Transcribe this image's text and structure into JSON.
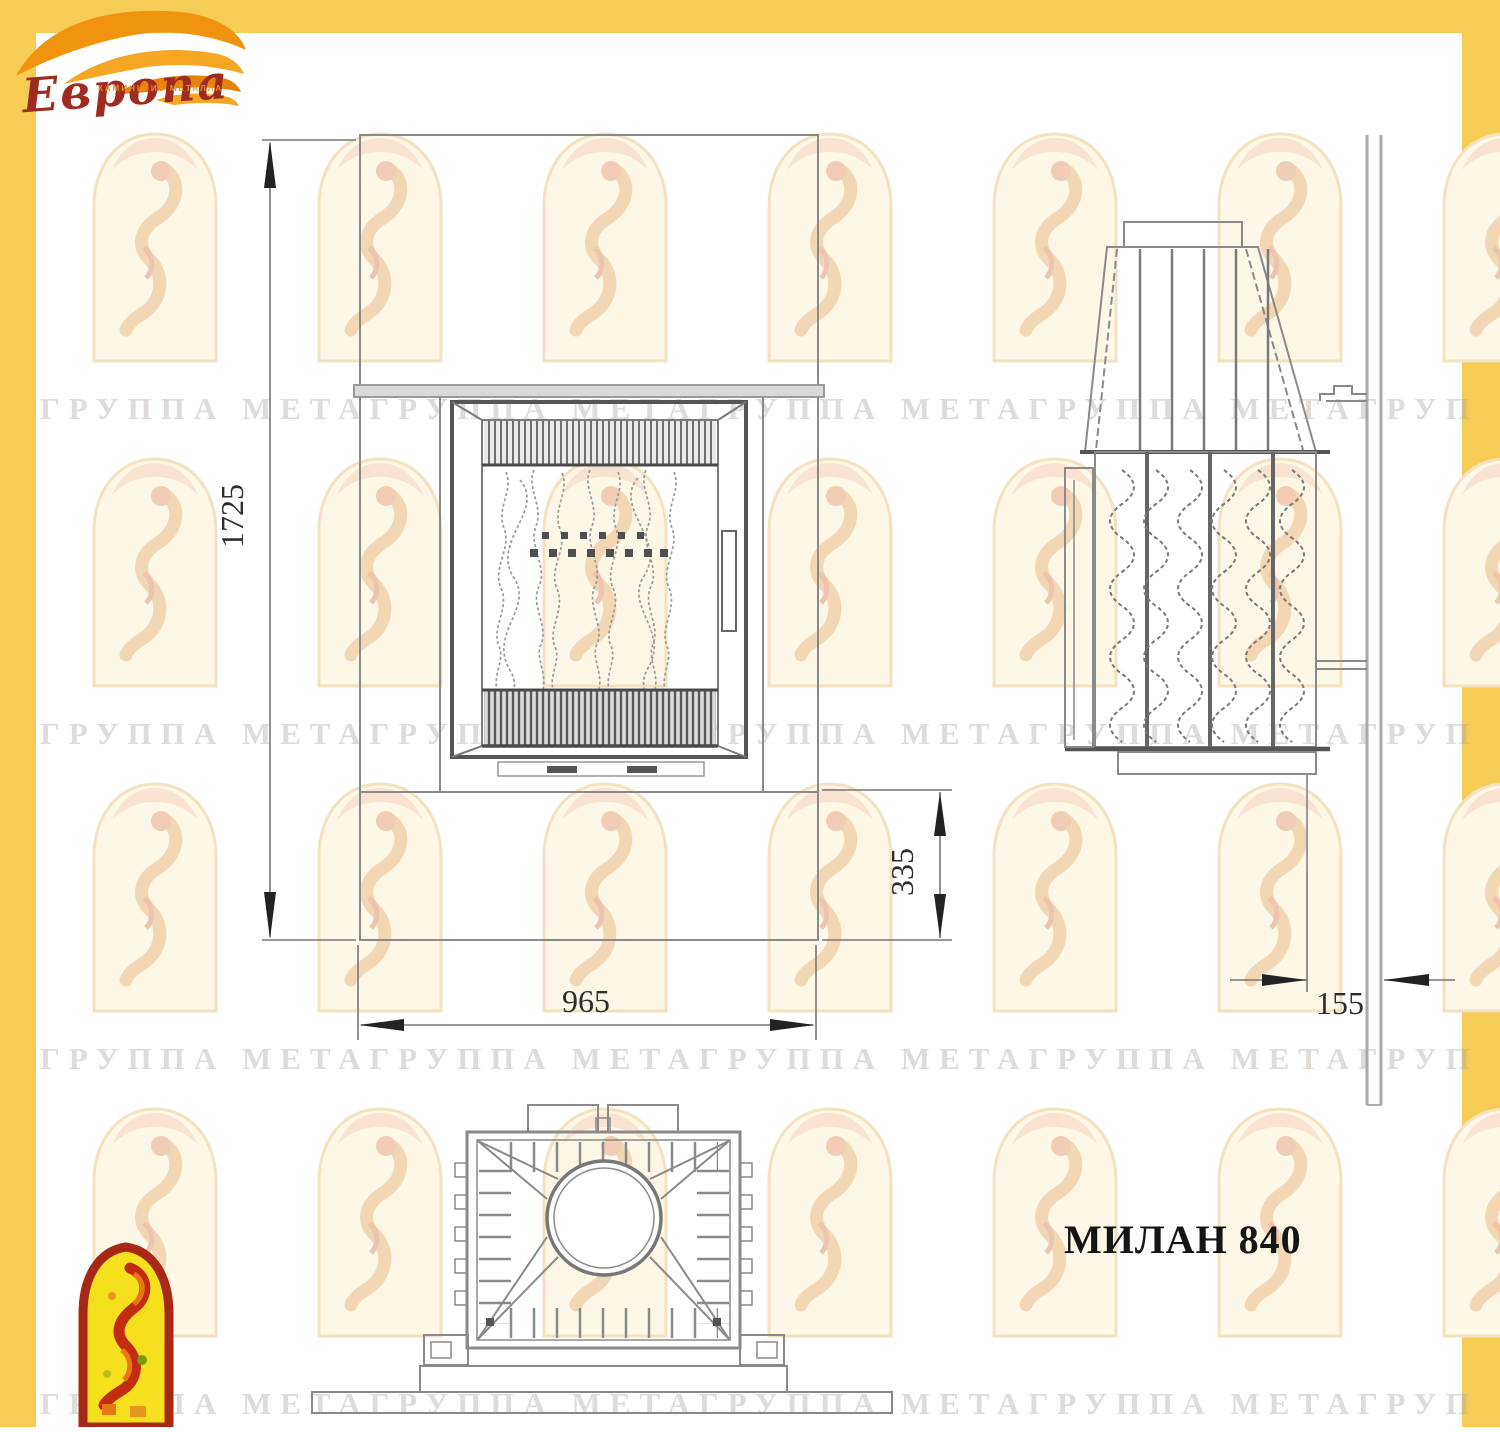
{
  "page": {
    "frame_color": "#F6CC55",
    "background": "#ffffff"
  },
  "logo": {
    "brand": "Европа",
    "caption": "КАМИНЫ ИЗ МЕТАЛЛА",
    "flame_color": "#F0930F",
    "text_color": "#9E2B20"
  },
  "watermark": {
    "row_text": "ГРУППА МЕТАГРУППА МЕТАГРУППА МЕТАГРУППА МЕТАГРУППА МЕТА"
  },
  "drawing": {
    "title": "МИЛАН 840",
    "dimensions": {
      "overall_height": "1725",
      "overall_width": "965",
      "plinth_height": "335",
      "depth": "155"
    },
    "line_color": "#8a8a8a",
    "heavy_line_color": "#4a4a4a",
    "dim_text_color": "#2e2e2e"
  }
}
